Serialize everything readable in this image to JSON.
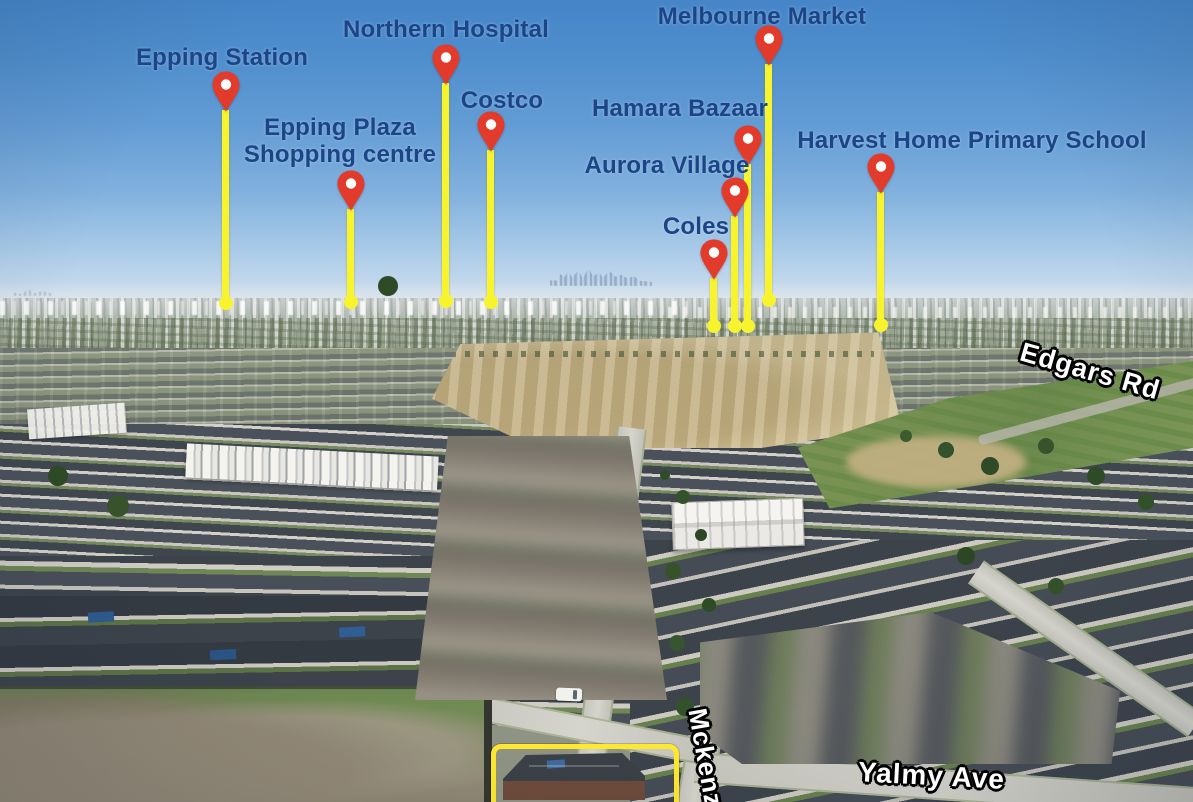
{
  "pins": [
    {
      "label": "Epping Station"
    },
    {
      "label": "Epping Plaza",
      "label2": "Shopping centre"
    },
    {
      "label": "Northern Hospital"
    },
    {
      "label": "Costco"
    },
    {
      "label": "Melbourne Market"
    },
    {
      "label": "Hamara Bazaar"
    },
    {
      "label": "Aurora Village"
    },
    {
      "label": "Coles"
    },
    {
      "label": "Harvest Home Primary School"
    }
  ],
  "road_labels": {
    "edgars": "Edgars Rd",
    "yalmy": "Yalmy Ave",
    "mckenzie": "Mckenzie"
  },
  "colors": {
    "pin_red": "#e23b2c",
    "line_yellow": "#f7f42e",
    "label_blue": "#1c4587",
    "road_text": "#ffffff",
    "road_outline": "#000000",
    "highlight_box": "#ffe82d"
  }
}
